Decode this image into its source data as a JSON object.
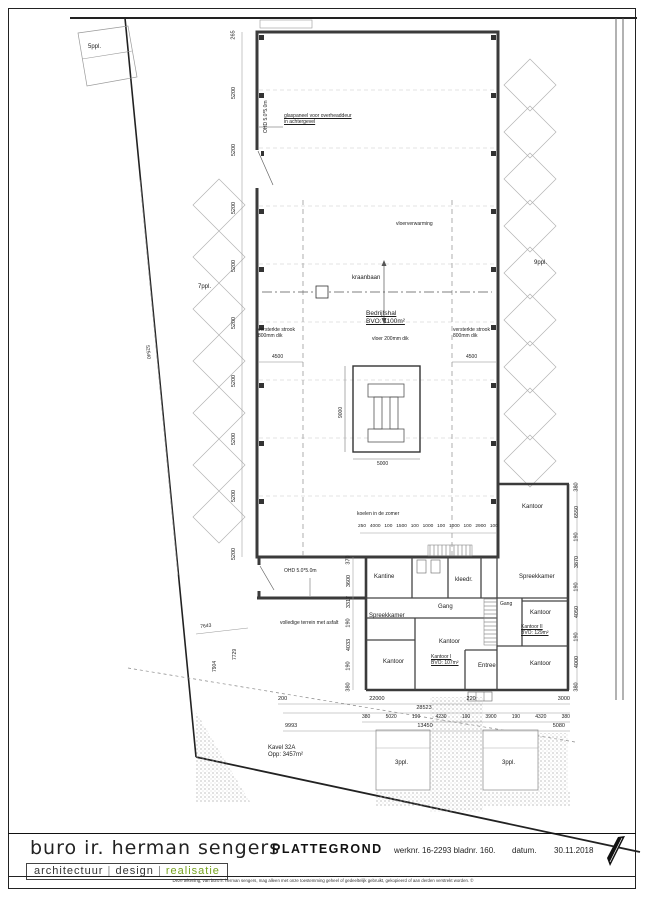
{
  "title_block": {
    "firm": "buro ir. herman sengers",
    "tagline": [
      "architectuur",
      "design",
      "realisatie"
    ],
    "sep": "|",
    "drawing_title": "PLATTEGROND",
    "werknr": "werknr. 16-2293 bladnr. 160.",
    "datum_label": "datum.",
    "datum_value": "30.11.2018",
    "disclaimer": "Deze tekening, van buro ir. herman sengers, mag alleen met onze toestemming geheel of gedeeltelijk gebruikt, gekopieerd of aan derden verstrekt worden. ©",
    "accent_color": "#76a21e"
  },
  "site": {
    "parking_top_left": "5ppl.",
    "parking_left": "7ppl.",
    "parking_right": "9ppl.",
    "parking_bottom_left": "3ppl.",
    "parking_bottom_right": "3ppl.",
    "kavel_name": "Kavel 32A",
    "kavel_area": "Opp: 3457m²",
    "boundary_dim": "52540",
    "asphalt_note": "volledige terrein met asfalt",
    "dim_diag": "7643",
    "dim_v1": "7729",
    "dim_v2": "7904"
  },
  "hall": {
    "name": "Bedrijfshal",
    "bvo": "BVO: 1100m²",
    "floor_note": "vloer 200mm dik",
    "heating_note": "vloerverwarming",
    "crane_label": "kraanbaan",
    "strip_note": "versterkte strook 800mm dik",
    "strip_dim": "4500",
    "machine_width": "5000",
    "machine_depth": "9000",
    "overhead_door": "OHD 5.0*5.0m",
    "glass_note_1": "glaspaneel voor overheaddeur",
    "glass_note_2": "in achtergevel",
    "cooling_note": "koelen in de zomer"
  },
  "office": {
    "overhead_door": "OHD 5.0*5.0m"
  },
  "rooms": {
    "kantine": "Kantine",
    "kleedr": "kleedr.",
    "spreekkamer_wing": "Spreekkamer",
    "spreekkamer_left": "Spreekkamer",
    "gang_main": "Gang",
    "gang_wing": "Gang",
    "kantoor_wing_top": "Kantoor",
    "kantoor_wing_mid": "Kantoor",
    "kantoor_wing_bottom": "Kantoor",
    "kantoor_center": "Kantoor",
    "kantoor_left": "Kantoor",
    "kantoor_I": "Kantoor I",
    "kantoor_I_bvo": "BVO: 107m²",
    "kantoor_II": "Kantoor II",
    "kantoor_II_bvo": "BVO: 129m²",
    "entree": "Entree"
  },
  "dims": {
    "left_chain": [
      "265",
      "5200",
      "5200",
      "5200",
      "5200",
      "5200",
      "5200",
      "5200",
      "5200",
      "5200"
    ],
    "right_chain": [
      "380",
      "6550",
      "190",
      "3870",
      "190",
      "4050",
      "190",
      "4000",
      "380"
    ],
    "office_left_chain": [
      "370",
      "3600",
      "3317",
      "190",
      "4033",
      "190",
      "380"
    ],
    "top_office_row": [
      "250",
      "4000",
      "100",
      "1500",
      "100",
      "1000",
      "100",
      "1000",
      "100",
      "2900",
      "100"
    ],
    "bottom_row1": [
      "200",
      "22000",
      "220",
      "3000"
    ],
    "bottom_row2": [
      "28523"
    ],
    "bottom_row3": [
      "380",
      "5020",
      "190",
      "4230",
      "190",
      "3900",
      "190",
      "4320",
      "380"
    ],
    "bottom_row4": [
      "9993",
      "13450",
      "5080"
    ]
  }
}
